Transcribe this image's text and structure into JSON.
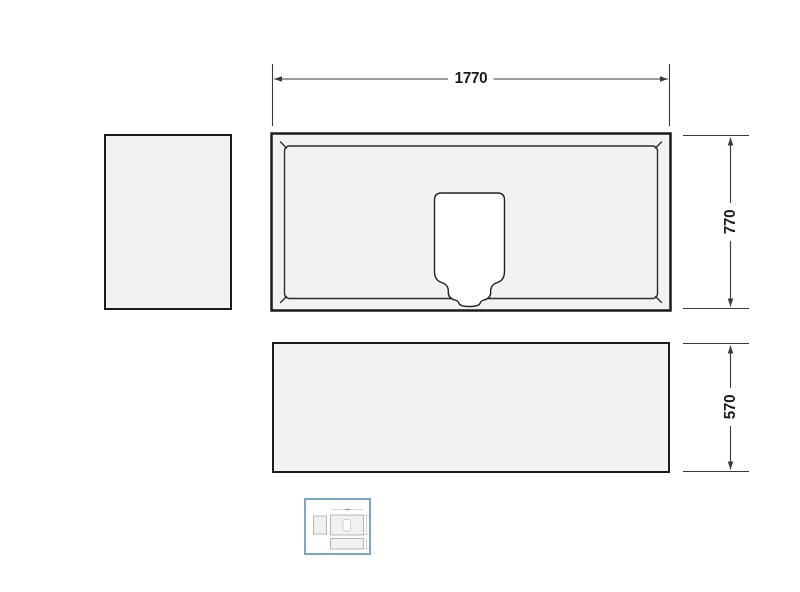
{
  "page": {
    "background": "#ffffff"
  },
  "drawing": {
    "title": "panel-dimension-drawing",
    "labels": {
      "top_width": "1770",
      "side_height": "770",
      "front_height": "570"
    },
    "colors": {
      "line": "#1b1b1b",
      "dim_line": "#3a3a3a",
      "panel_fill": "#f2f2f2",
      "cutout_fill": "#ffffff",
      "label_text": "#1a1a1a",
      "thumbnail_border": "#7ba6c4"
    }
  },
  "thumbnail": {
    "selected": true
  }
}
